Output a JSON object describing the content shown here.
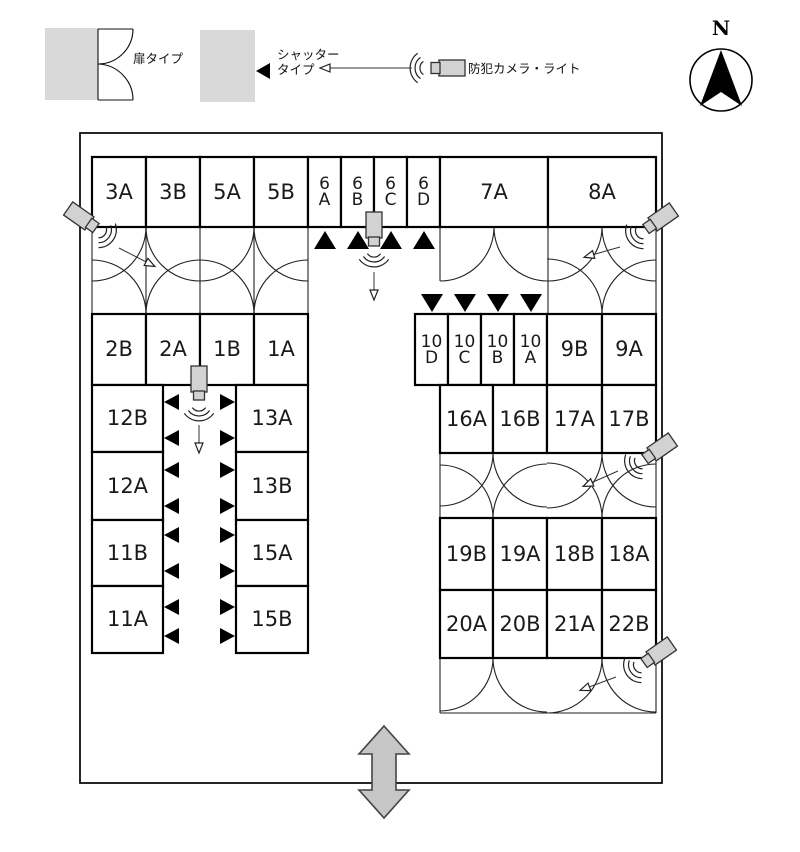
{
  "legend": {
    "door": {
      "label": "扉タイプ"
    },
    "shutter": {
      "label_lines": [
        "シャッター",
        "タイプ"
      ]
    },
    "camera": {
      "label": "防犯カメラ・ライト",
      "icon": {
        "x": 431,
        "y": 68,
        "angle": 180,
        "arrow": [
          412,
          68,
          321,
          68
        ]
      }
    }
  },
  "compass": {
    "label": "N"
  },
  "icons": {
    "shutter": "filled-triangle",
    "camera": "security-camera-light",
    "compass": "north-arrow",
    "entrance": "double-headed-arrow",
    "door": "double-door-swing-arcs"
  },
  "colors": {
    "line": "#000000",
    "unit_fill": "#ffffff",
    "gray_fill": "#d9d9d9",
    "camera_fill": "#d2d2d2",
    "entrance_fill": "#c6c6c6"
  },
  "plan": {
    "units": [
      {
        "label": [
          "3A"
        ],
        "x": 92,
        "y": 157,
        "w": 54,
        "h": 70
      },
      {
        "label": [
          "3B"
        ],
        "x": 146,
        "y": 157,
        "w": 54,
        "h": 70
      },
      {
        "label": [
          "5A"
        ],
        "x": 200,
        "y": 157,
        "w": 54,
        "h": 70
      },
      {
        "label": [
          "5B"
        ],
        "x": 254,
        "y": 157,
        "w": 54,
        "h": 70
      },
      {
        "label": [
          "6",
          "A"
        ],
        "x": 308,
        "y": 157,
        "w": 33,
        "h": 70
      },
      {
        "label": [
          "6",
          "B"
        ],
        "x": 341,
        "y": 157,
        "w": 33,
        "h": 70
      },
      {
        "label": [
          "6",
          "C"
        ],
        "x": 374,
        "y": 157,
        "w": 33,
        "h": 70
      },
      {
        "label": [
          "6",
          "D"
        ],
        "x": 407,
        "y": 157,
        "w": 33,
        "h": 70
      },
      {
        "label": [
          "7A"
        ],
        "x": 440,
        "y": 157,
        "w": 108,
        "h": 70
      },
      {
        "label": [
          "8A"
        ],
        "x": 548,
        "y": 157,
        "w": 108,
        "h": 70
      },
      {
        "label": [
          "2B"
        ],
        "x": 92,
        "y": 314,
        "w": 54,
        "h": 71
      },
      {
        "label": [
          "2A"
        ],
        "x": 146,
        "y": 314,
        "w": 54,
        "h": 71
      },
      {
        "label": [
          "1B"
        ],
        "x": 200,
        "y": 314,
        "w": 54,
        "h": 71
      },
      {
        "label": [
          "1A"
        ],
        "x": 254,
        "y": 314,
        "w": 54,
        "h": 71
      },
      {
        "label": [
          "10",
          "D"
        ],
        "x": 415,
        "y": 314,
        "w": 33,
        "h": 71
      },
      {
        "label": [
          "10",
          "C"
        ],
        "x": 448,
        "y": 314,
        "w": 33,
        "h": 71
      },
      {
        "label": [
          "10",
          "B"
        ],
        "x": 481,
        "y": 314,
        "w": 33,
        "h": 71
      },
      {
        "label": [
          "10",
          "A"
        ],
        "x": 514,
        "y": 314,
        "w": 33,
        "h": 71
      },
      {
        "label": [
          "9B"
        ],
        "x": 547,
        "y": 314,
        "w": 55,
        "h": 71
      },
      {
        "label": [
          "9A"
        ],
        "x": 602,
        "y": 314,
        "w": 54,
        "h": 71
      },
      {
        "label": [
          "12B"
        ],
        "x": 92,
        "y": 385,
        "w": 71,
        "h": 67
      },
      {
        "label": [
          "13A"
        ],
        "x": 236,
        "y": 385,
        "w": 72,
        "h": 67
      },
      {
        "label": [
          "12A"
        ],
        "x": 92,
        "y": 452,
        "w": 71,
        "h": 68
      },
      {
        "label": [
          "13B"
        ],
        "x": 236,
        "y": 452,
        "w": 72,
        "h": 68
      },
      {
        "label": [
          "11B"
        ],
        "x": 92,
        "y": 520,
        "w": 71,
        "h": 66
      },
      {
        "label": [
          "15A"
        ],
        "x": 236,
        "y": 520,
        "w": 72,
        "h": 66
      },
      {
        "label": [
          "11A"
        ],
        "x": 92,
        "y": 586,
        "w": 71,
        "h": 67
      },
      {
        "label": [
          "15B"
        ],
        "x": 236,
        "y": 586,
        "w": 72,
        "h": 67
      },
      {
        "label": [
          "16A"
        ],
        "x": 440,
        "y": 385,
        "w": 53,
        "h": 68
      },
      {
        "label": [
          "16B"
        ],
        "x": 493,
        "y": 385,
        "w": 54,
        "h": 68
      },
      {
        "label": [
          "17A"
        ],
        "x": 547,
        "y": 385,
        "w": 55,
        "h": 68
      },
      {
        "label": [
          "17B"
        ],
        "x": 602,
        "y": 385,
        "w": 54,
        "h": 68
      },
      {
        "label": [
          "19B"
        ],
        "x": 440,
        "y": 518,
        "w": 53,
        "h": 72
      },
      {
        "label": [
          "19A"
        ],
        "x": 493,
        "y": 518,
        "w": 54,
        "h": 72
      },
      {
        "label": [
          "18B"
        ],
        "x": 547,
        "y": 518,
        "w": 55,
        "h": 72
      },
      {
        "label": [
          "18A"
        ],
        "x": 602,
        "y": 518,
        "w": 54,
        "h": 72
      },
      {
        "label": [
          "20A"
        ],
        "x": 440,
        "y": 590,
        "w": 53,
        "h": 68
      },
      {
        "label": [
          "20B"
        ],
        "x": 493,
        "y": 590,
        "w": 54,
        "h": 68
      },
      {
        "label": [
          "21A"
        ],
        "x": 547,
        "y": 590,
        "w": 55,
        "h": 68
      },
      {
        "label": [
          "22B"
        ],
        "x": 602,
        "y": 590,
        "w": 54,
        "h": 68
      }
    ],
    "shutters": [
      {
        "dir": "up",
        "x": 325,
        "y": 231
      },
      {
        "dir": "up",
        "x": 358,
        "y": 231
      },
      {
        "dir": "up",
        "x": 391,
        "y": 231
      },
      {
        "dir": "up",
        "x": 424,
        "y": 231
      },
      {
        "dir": "down",
        "x": 432,
        "y": 312
      },
      {
        "dir": "down",
        "x": 465,
        "y": 312
      },
      {
        "dir": "down",
        "x": 498,
        "y": 312
      },
      {
        "dir": "down",
        "x": 531,
        "y": 312
      },
      {
        "dir": "left",
        "x": 164,
        "y": 402
      },
      {
        "dir": "right",
        "x": 235,
        "y": 402
      },
      {
        "dir": "left",
        "x": 164,
        "y": 438
      },
      {
        "dir": "right",
        "x": 235,
        "y": 438
      },
      {
        "dir": "left",
        "x": 164,
        "y": 470
      },
      {
        "dir": "right",
        "x": 235,
        "y": 470
      },
      {
        "dir": "left",
        "x": 164,
        "y": 506
      },
      {
        "dir": "right",
        "x": 235,
        "y": 506
      },
      {
        "dir": "left",
        "x": 164,
        "y": 535
      },
      {
        "dir": "right",
        "x": 235,
        "y": 535
      },
      {
        "dir": "left",
        "x": 164,
        "y": 571
      },
      {
        "dir": "right",
        "x": 235,
        "y": 571
      },
      {
        "dir": "left",
        "x": 164,
        "y": 607
      },
      {
        "dir": "right",
        "x": 235,
        "y": 607
      },
      {
        "dir": "left",
        "x": 164,
        "y": 636
      },
      {
        "dir": "right",
        "x": 235,
        "y": 636
      }
    ],
    "cameras": [
      {
        "x": 96,
        "y": 228,
        "angle": 35,
        "arrow": [
          119,
          248,
          154,
          266
        ]
      },
      {
        "x": 374,
        "y": 246,
        "angle": 90,
        "arrow": [
          374,
          272,
          374,
          299
        ]
      },
      {
        "x": 646,
        "y": 229,
        "angle": 145,
        "arrow": [
          620,
          247,
          585,
          257
        ]
      },
      {
        "x": 199,
        "y": 400,
        "angle": 90,
        "arrow": [
          199,
          425,
          199,
          452
        ]
      },
      {
        "x": 645,
        "y": 459,
        "angle": 145,
        "arrow": [
          618,
          471,
          584,
          486
        ]
      },
      {
        "x": 644,
        "y": 663,
        "angle": 145,
        "arrow": [
          616,
          677,
          581,
          690
        ]
      }
    ],
    "entrance_arrow": {
      "direction": "vertical-double"
    }
  }
}
